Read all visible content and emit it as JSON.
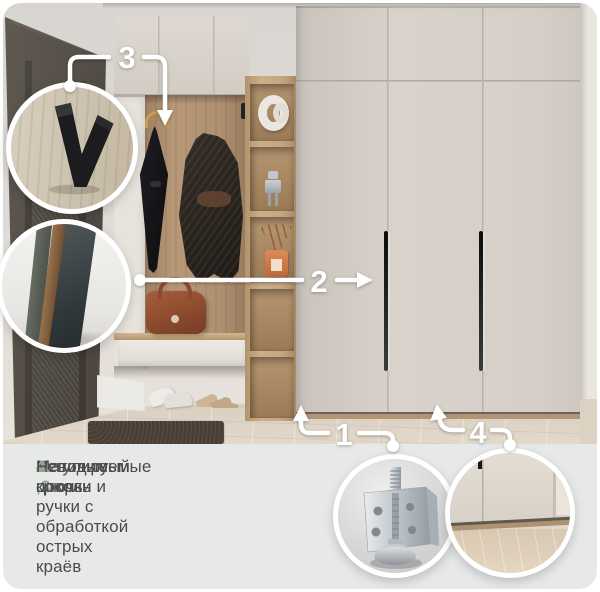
{
  "legend": {
    "items": [
      {
        "num": "1.",
        "text": "Регулируемые опоры"
      },
      {
        "num": "2 ,3.",
        "text": "Матовые крючки и ручки с обработкой острых краёв"
      },
      {
        "num": "4.",
        "text": "Невидимый цоколь"
      }
    ]
  },
  "markers": {
    "one": "1",
    "two": "2",
    "three": "3",
    "four": "4"
  },
  "icons": {
    "hook_callout": "v-hook-icon",
    "panels_callout": "rounded-edge-panels-icon",
    "foot_callout": "adjustable-foot-icon",
    "plinth_callout": "recessed-plinth-icon"
  },
  "colors": {
    "accent_green": "#8FA88F",
    "legend_bg": "#E7E9E8",
    "legend_text": "#4B4B4B",
    "annotation": "#FFFFFF",
    "wardrobe_front": "#D5CFC8",
    "oak_wood": "#B69878",
    "door": "#554F48"
  }
}
